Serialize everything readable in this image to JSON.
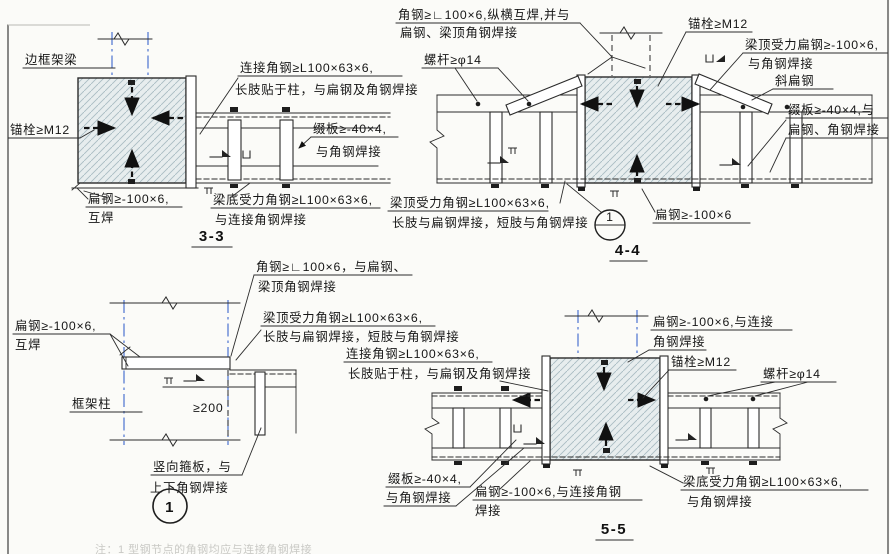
{
  "page": {
    "bg": "#fbfbf8",
    "line_color": "#2b2b2b",
    "centerline_color": "#3b66cc",
    "hatch_fill": "#e7edee",
    "hatch_line": "#a9bcc3"
  },
  "d33": {
    "title": "3-3",
    "labels": {
      "frame_beam": "边框架梁",
      "anchor": "锚栓≥M12",
      "flat1a": "扁钢≥-100×6,",
      "flat1b": "互焊",
      "conn1": "连接角钢≥L100×63×6,",
      "conn2": "长肢贴于柱，与扁钢及角钢焊接",
      "batten1": "缀板≥-40×4,",
      "batten2": "与角钢焊接",
      "bottom1": "梁底受力角钢≥L100×63×6,",
      "bottom2": "与连接角钢焊接"
    }
  },
  "d44": {
    "title": "4-4",
    "bubble_no": "1",
    "labels": {
      "corner1": "角钢≥∟100×6,纵横互焊,并与",
      "corner2": "扁钢、梁顶角钢焊接",
      "rod": "螺杆≥φ14",
      "anchor": "锚栓≥M12",
      "topflat1": "梁顶受力扁钢≥-100×6,",
      "topflat2": "与角钢焊接",
      "diag": "斜扁钢",
      "batten1": "缀板≥-40×4,与",
      "batten2": "扁钢、角钢焊接",
      "flat": "扁钢≥-100×6",
      "topangle1": "梁顶受力角钢≥L100×63×6,",
      "topangle2": "长肢与扁钢焊接，短肢与角钢焊接"
    }
  },
  "d1": {
    "title": "1",
    "labels": {
      "corner1": "角钢≥∟100×6，与扁钢、",
      "corner2": "梁顶角钢焊接",
      "flat1": "扁钢≥-100×6,",
      "flat2": "互焊",
      "topangle1": "梁顶受力角钢≥L100×63×6,",
      "topangle2": "长肢与扁钢焊接，短肢与角钢焊接",
      "column": "框架柱",
      "dim": "≥200",
      "stiff1": "竖向箍板，与",
      "stiff2": "上下角钢焊接"
    },
    "note": "注：1 型钢节点的角钢均应与连接角钢焊接"
  },
  "d55": {
    "title": "5-5",
    "labels": {
      "conn1": "连接角钢≥L100×63×6,",
      "conn2": "长肢贴于柱，与扁钢及角钢焊接",
      "flat_top1": "扁钢≥-100×6,与连接",
      "flat_top2": "角钢焊接",
      "anchor": "锚栓≥M12",
      "rod": "螺杆≥φ14",
      "batten1": "缀板≥-40×4,",
      "batten2": "与角钢焊接",
      "flat_bot1": "扁钢≥-100×6,与连接角钢",
      "flat_bot2": "焊接",
      "bottom1": "梁底受力角钢≥L100×63×6,",
      "bottom2": "与角钢焊接"
    }
  }
}
